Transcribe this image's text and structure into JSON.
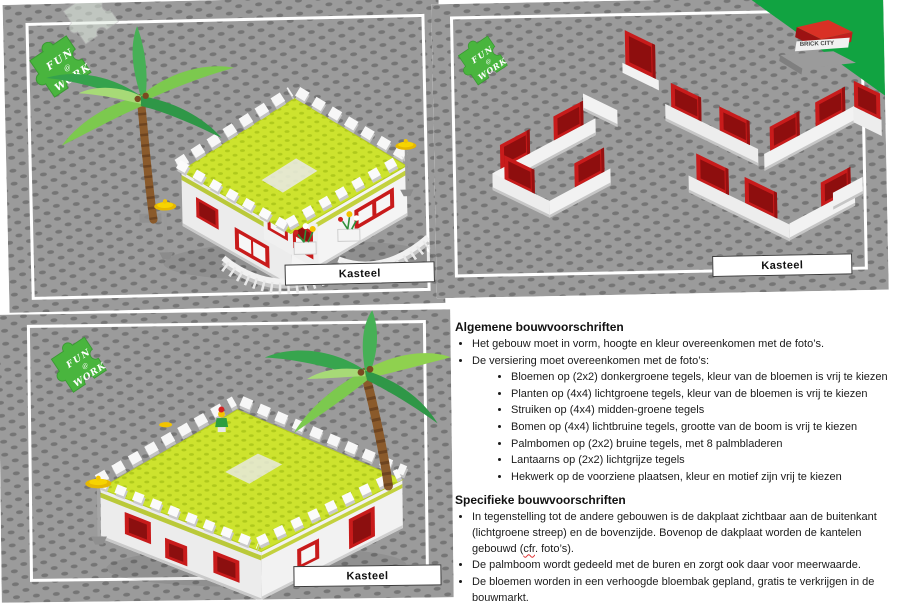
{
  "logos": {
    "fun_at_work": {
      "line1": "FUN",
      "line2": "@",
      "line3": "WORK"
    },
    "brick_city": "BRICK CITY"
  },
  "figures": {
    "front_view": {
      "caption": "Kasteel"
    },
    "walls_view": {
      "caption": "Kasteel"
    },
    "back_view": {
      "caption": "Kasteel"
    }
  },
  "instructions": {
    "general": {
      "heading": "Algemene bouwvoorschriften",
      "bullets": [
        "Het gebouw moet in vorm, hoogte en kleur overeenkomen met de foto’s.",
        "De versiering moet overeenkomen met de foto’s:"
      ],
      "sub_bullets": [
        "Bloemen op (2x2) donkergroene tegels, kleur van de bloemen is vrij te kiezen",
        "Planten op (4x4) lichtgroene tegels, kleur van de bloemen is vrij te kiezen",
        "Struiken op (4x4) midden-groene tegels",
        "Bomen op (4x4) lichtbruine tegels, grootte van de boom is vrij te kiezen",
        "Palmbomen op (2x2) bruine tegels, met 8 palmbladeren",
        "Lantaarns op (2x2) lichtgrijze tegels",
        "Hekwerk op de voorziene plaatsen, kleur en motief zijn vrij te kiezen"
      ]
    },
    "specific": {
      "heading": "Specifieke bouwvoorschriften",
      "bullet1_pre": "In tegenstelling tot de andere gebouwen is de dakplaat zichtbaar aan de buitenkant (lichtgroene streep) en de bovenzijde. Bovenop de dakplaat worden de kantelen gebouwd (",
      "bullet1_word": "cfr",
      "bullet1_post": ". foto’s).",
      "bullets": [
        "De palmboom wordt gedeeld met de buren en zorgt ook daar voor meerwaarde.",
        "De bloemen worden in een verhoogde bloembak gepland, gratis te verkrijgen in de bouwmarkt."
      ]
    }
  },
  "colors": {
    "baseplate_gray": "#9b9b9b",
    "stud_gray": "#757575",
    "roof_lime": "#cde32e",
    "brick_red": "#c81b1b",
    "brick_white": "#f2f2f2",
    "stripe_olive": "#bac93a",
    "logo_green": "#49b53e",
    "brick_city_green": "#11a341",
    "lantern_yellow": "#f2c400",
    "palm_green_dark": "#2f9747",
    "palm_green_light": "#8fd14f",
    "trunk_brown": "#8a5a2b"
  }
}
